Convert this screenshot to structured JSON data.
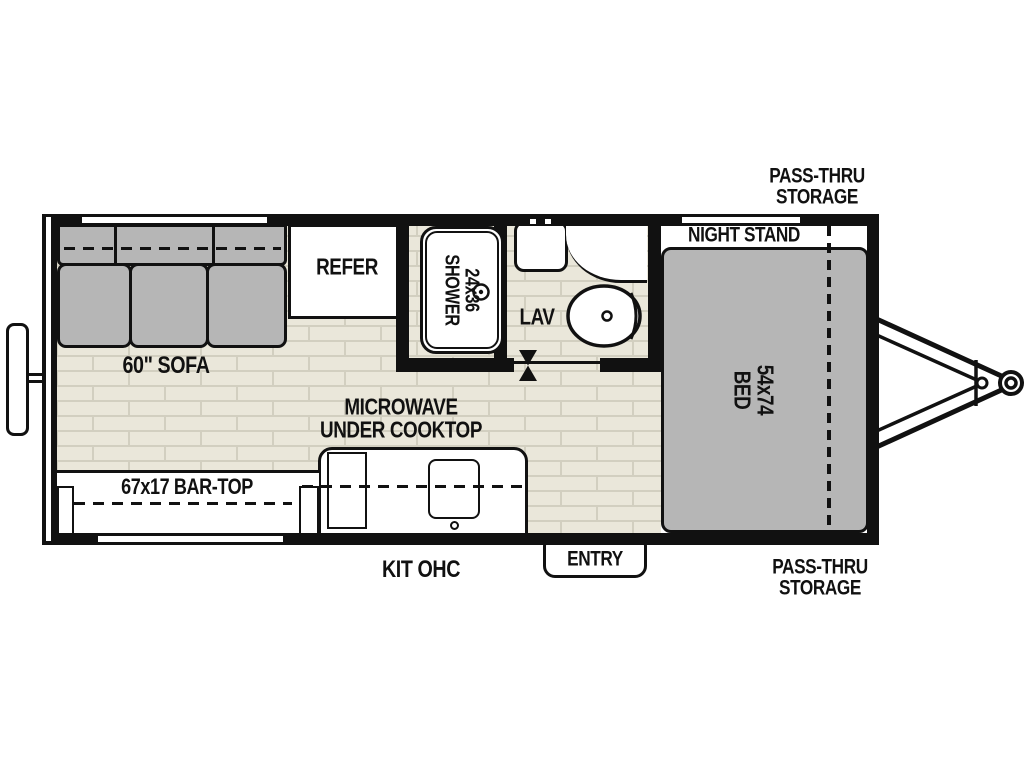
{
  "title": "Travel trailer floor plan",
  "labels": {
    "pass_thru_top": "PASS-THRU\nSTORAGE",
    "pass_thru_bottom": "PASS-THRU\nSTORAGE",
    "night_stand": "NIGHT STAND",
    "bed": "54x74\nBED",
    "shower": "24x36\nSHOWER",
    "lav": "LAV",
    "refer": "REFER",
    "sofa": "60\" SOFA",
    "microwave": "MICROWAVE\nUNDER COOKTOP",
    "bar_top": "67x17 BAR-TOP",
    "kit_ohc": "KIT OHC",
    "entry": "ENTRY"
  },
  "colors": {
    "wall": "#111111",
    "furniture_gray": "#b6b6b6",
    "floor": "#eae7da",
    "floor_joint": "#d2cfc0",
    "background": "#ffffff"
  },
  "features": [
    "60 inch sofa",
    "refrigerator",
    "24x36 shower",
    "lavatory with sink and toilet",
    "54x74 bed",
    "night stand",
    "pass-thru storage front",
    "microwave under cooktop",
    "67x17 bar-top",
    "kitchen overhead cabinet",
    "entry door",
    "rear bumper",
    "a-frame tongue hitch"
  ]
}
